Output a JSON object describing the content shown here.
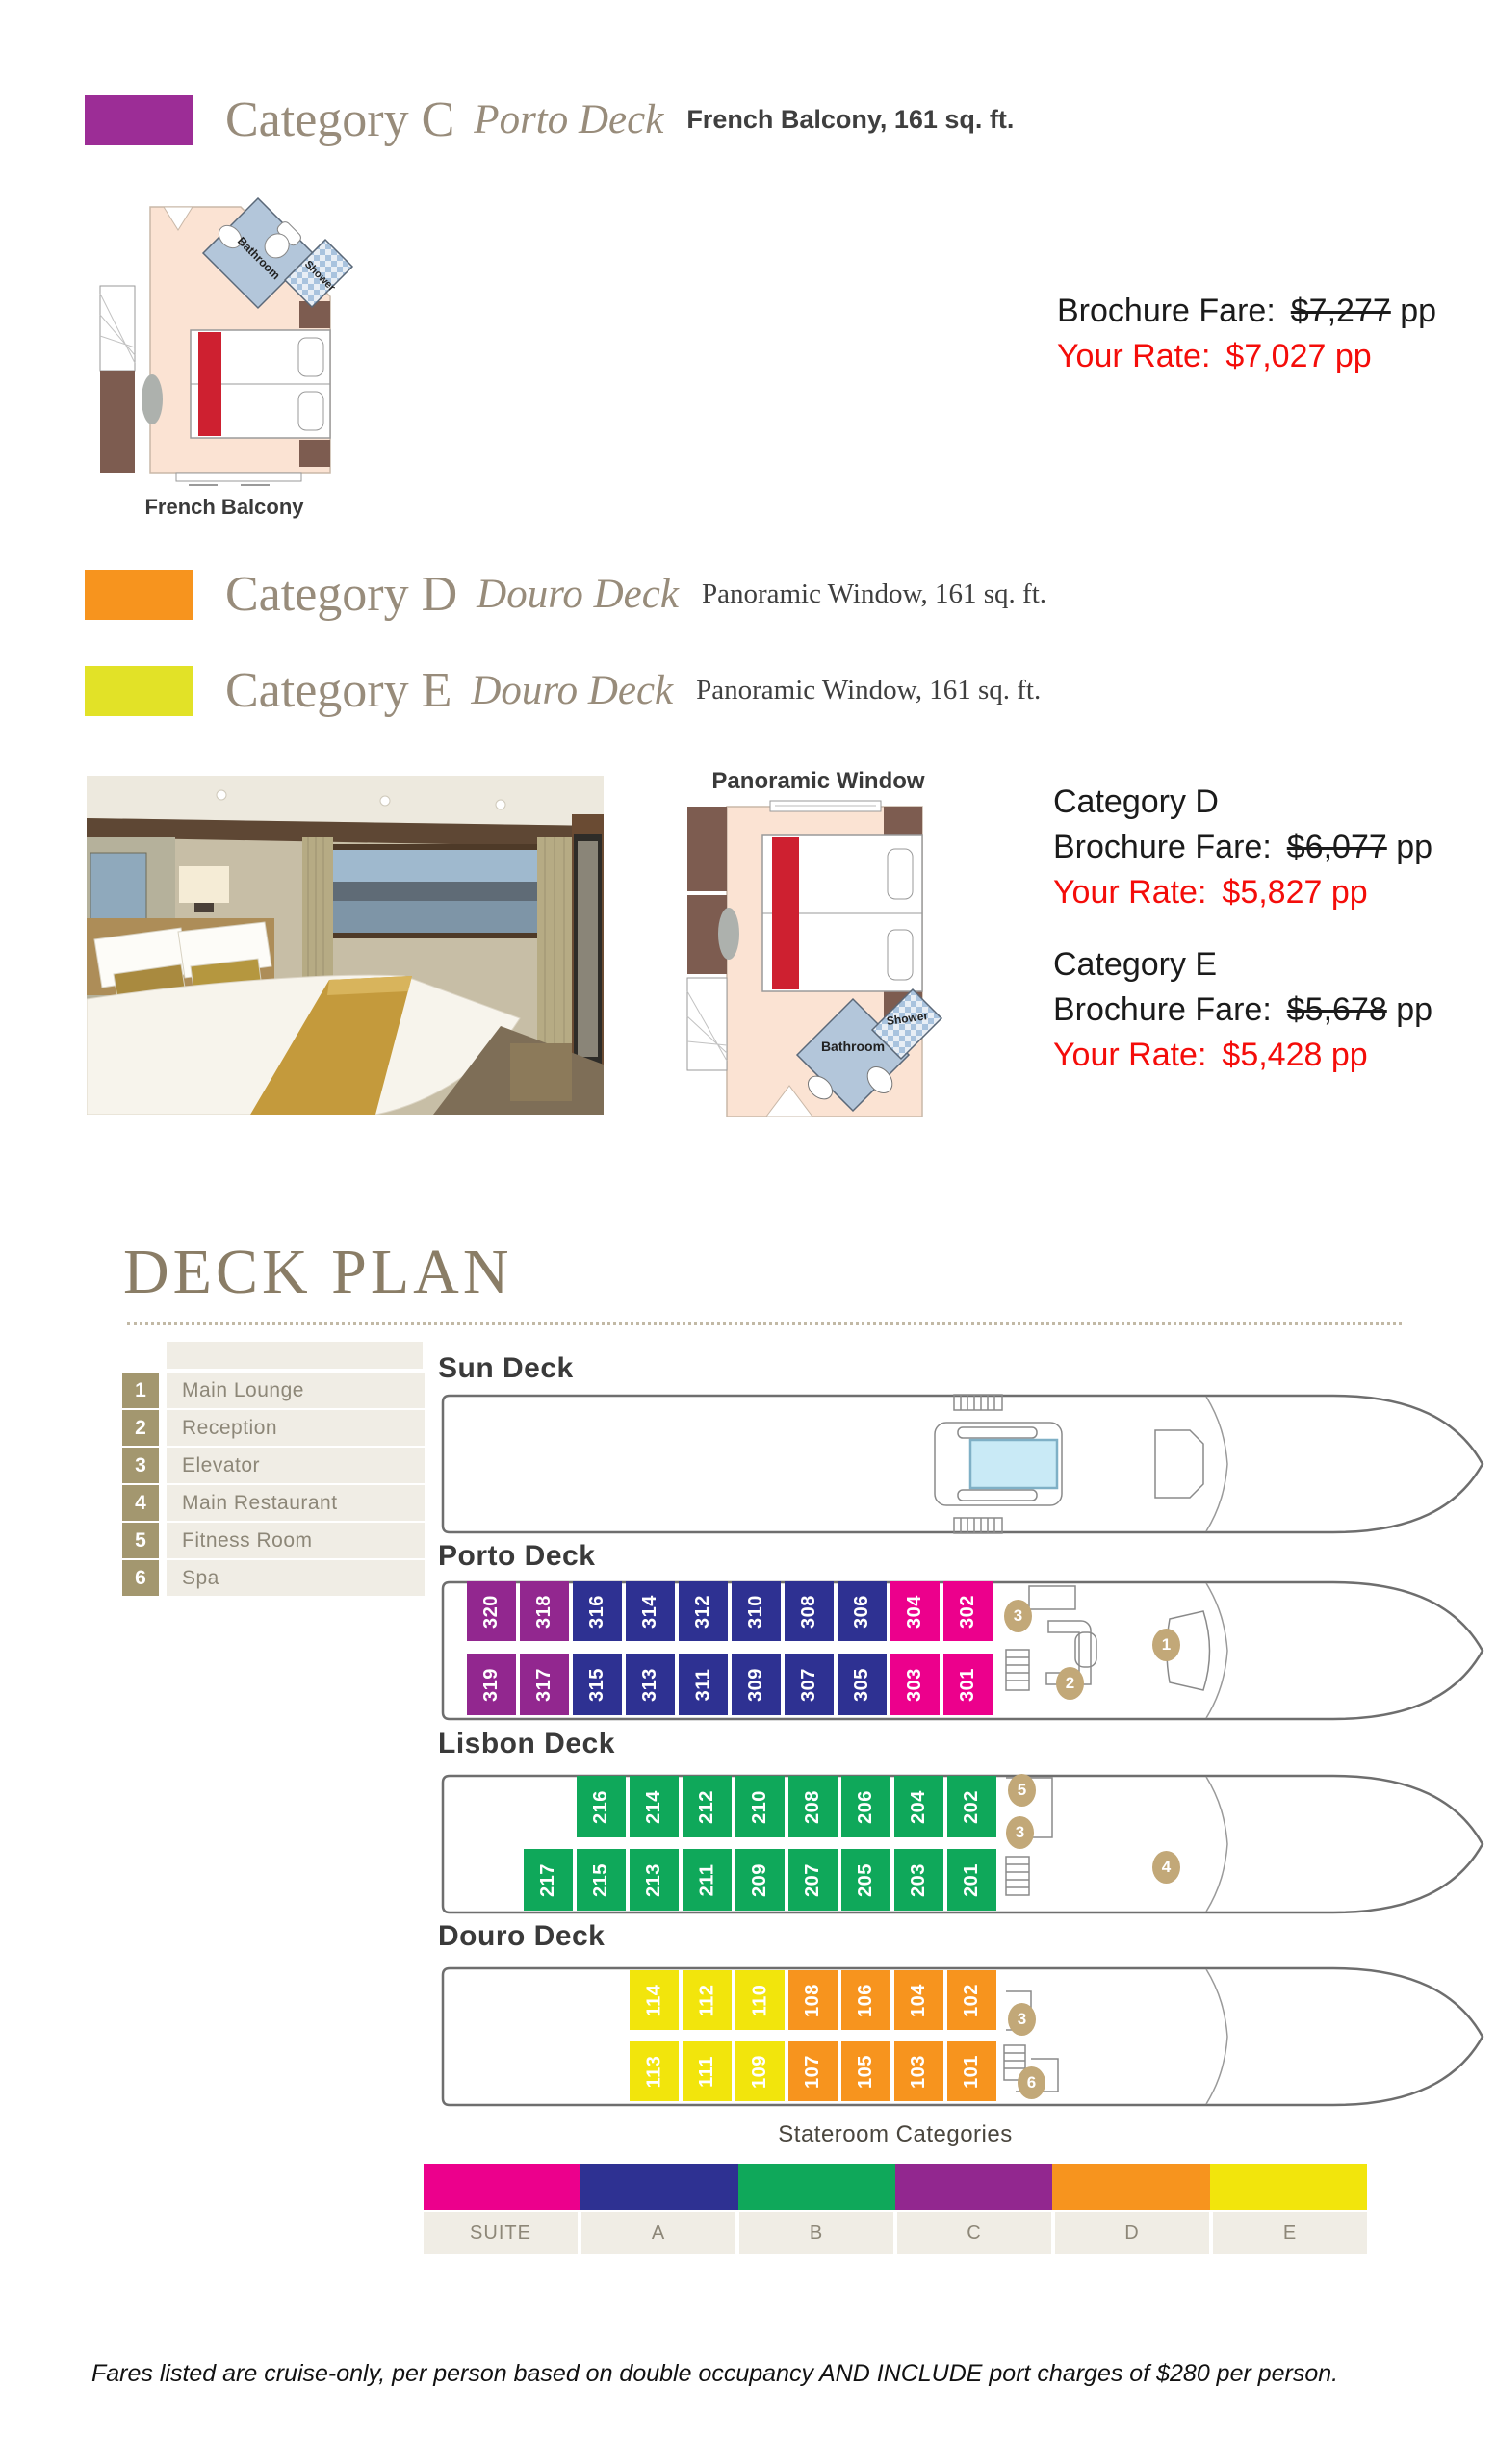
{
  "header": {
    "categories": [
      {
        "title": "Category C",
        "deck": "Porto Deck",
        "detail": "French Balcony, 161 sq. ft.",
        "color": "#9C2D96"
      },
      {
        "title": "Category D",
        "deck": "Douro Deck",
        "detail": "Panoramic Window, 161 sq. ft.",
        "color": "#F7941E"
      },
      {
        "title": "Category E",
        "deck": "Douro Deck",
        "detail": "Panoramic Window, 161 sq. ft.",
        "color": "#E2E227"
      }
    ]
  },
  "pricing": {
    "c": {
      "brochure_label": "Brochure Fare:",
      "brochure_price": "$7,277",
      "suffix": "pp",
      "rate_label": "Your Rate:",
      "rate_price": "$7,027 pp"
    },
    "d": {
      "category": "Category D",
      "brochure_label": "Brochure Fare:",
      "brochure_price": "$6,077",
      "suffix": "pp",
      "rate_label": "Your Rate:",
      "rate_price": "$5,827 pp"
    },
    "e": {
      "category": "Category E",
      "brochure_label": "Brochure Fare:",
      "brochure_price": "$5,678",
      "suffix": "pp",
      "rate_label": "Your Rate:",
      "rate_price": "$5,428 pp"
    }
  },
  "floorplans": {
    "french_balcony": {
      "label": "French Balcony",
      "bathroom": "Bathroom",
      "shower": "Shower"
    },
    "panoramic": {
      "label": "Panoramic Window",
      "bathroom": "Bathroom",
      "shower": "Shower"
    }
  },
  "deck_plan": {
    "title": "DECK PLAN",
    "legend": [
      {
        "num": "1",
        "label": "Main Lounge"
      },
      {
        "num": "2",
        "label": "Reception"
      },
      {
        "num": "3",
        "label": "Elevator"
      },
      {
        "num": "4",
        "label": "Main Restaurant"
      },
      {
        "num": "5",
        "label": "Fitness Room"
      },
      {
        "num": "6",
        "label": "Spa"
      }
    ],
    "category_colors": {
      "SUITE": "#EC008C",
      "A": "#2E3192",
      "B": "#0FA85A",
      "C": "#92278F",
      "D": "#F7941E",
      "E": "#F2E50C"
    },
    "marker_color": "#C2A878",
    "decks": [
      {
        "name": "Sun Deck",
        "rows": [],
        "markers": []
      },
      {
        "name": "Porto Deck",
        "rows": [
          [
            {
              "num": "320",
              "cat": "C"
            },
            {
              "num": "318",
              "cat": "C"
            },
            {
              "num": "316",
              "cat": "A"
            },
            {
              "num": "314",
              "cat": "A"
            },
            {
              "num": "312",
              "cat": "A"
            },
            {
              "num": "310",
              "cat": "A"
            },
            {
              "num": "308",
              "cat": "A"
            },
            {
              "num": "306",
              "cat": "A"
            },
            {
              "num": "304",
              "cat": "SUITE"
            },
            {
              "num": "302",
              "cat": "SUITE"
            }
          ],
          [
            {
              "num": "319",
              "cat": "C"
            },
            {
              "num": "317",
              "cat": "C"
            },
            {
              "num": "315",
              "cat": "A"
            },
            {
              "num": "313",
              "cat": "A"
            },
            {
              "num": "311",
              "cat": "A"
            },
            {
              "num": "309",
              "cat": "A"
            },
            {
              "num": "307",
              "cat": "A"
            },
            {
              "num": "305",
              "cat": "A"
            },
            {
              "num": "303",
              "cat": "SUITE"
            },
            {
              "num": "301",
              "cat": "SUITE"
            }
          ]
        ],
        "markers": [
          "3",
          "2",
          "1"
        ]
      },
      {
        "name": "Lisbon Deck",
        "rows": [
          [
            {
              "num": "216",
              "cat": "B"
            },
            {
              "num": "214",
              "cat": "B"
            },
            {
              "num": "212",
              "cat": "B"
            },
            {
              "num": "210",
              "cat": "B"
            },
            {
              "num": "208",
              "cat": "B"
            },
            {
              "num": "206",
              "cat": "B"
            },
            {
              "num": "204",
              "cat": "B"
            },
            {
              "num": "202",
              "cat": "B"
            }
          ],
          [
            {
              "num": "217",
              "cat": "B"
            },
            {
              "num": "215",
              "cat": "B"
            },
            {
              "num": "213",
              "cat": "B"
            },
            {
              "num": "211",
              "cat": "B"
            },
            {
              "num": "209",
              "cat": "B"
            },
            {
              "num": "207",
              "cat": "B"
            },
            {
              "num": "205",
              "cat": "B"
            },
            {
              "num": "203",
              "cat": "B"
            },
            {
              "num": "201",
              "cat": "B"
            }
          ]
        ],
        "markers": [
          "5",
          "3",
          "4"
        ]
      },
      {
        "name": "Douro Deck",
        "rows": [
          [
            {
              "num": "114",
              "cat": "E"
            },
            {
              "num": "112",
              "cat": "E"
            },
            {
              "num": "110",
              "cat": "E"
            },
            {
              "num": "108",
              "cat": "D"
            },
            {
              "num": "106",
              "cat": "D"
            },
            {
              "num": "104",
              "cat": "D"
            },
            {
              "num": "102",
              "cat": "D"
            }
          ],
          [
            {
              "num": "113",
              "cat": "E"
            },
            {
              "num": "111",
              "cat": "E"
            },
            {
              "num": "109",
              "cat": "E"
            },
            {
              "num": "107",
              "cat": "D"
            },
            {
              "num": "105",
              "cat": "D"
            },
            {
              "num": "103",
              "cat": "D"
            },
            {
              "num": "101",
              "cat": "D"
            }
          ]
        ],
        "markers": [
          "3",
          "6"
        ]
      }
    ],
    "stateroom_legend": {
      "title": "Stateroom Categories",
      "items": [
        "SUITE",
        "A",
        "B",
        "C",
        "D",
        "E"
      ]
    }
  },
  "footer": "Fares listed are cruise-only, per person based on double occupancy AND INCLUDE port charges of $280 per person."
}
